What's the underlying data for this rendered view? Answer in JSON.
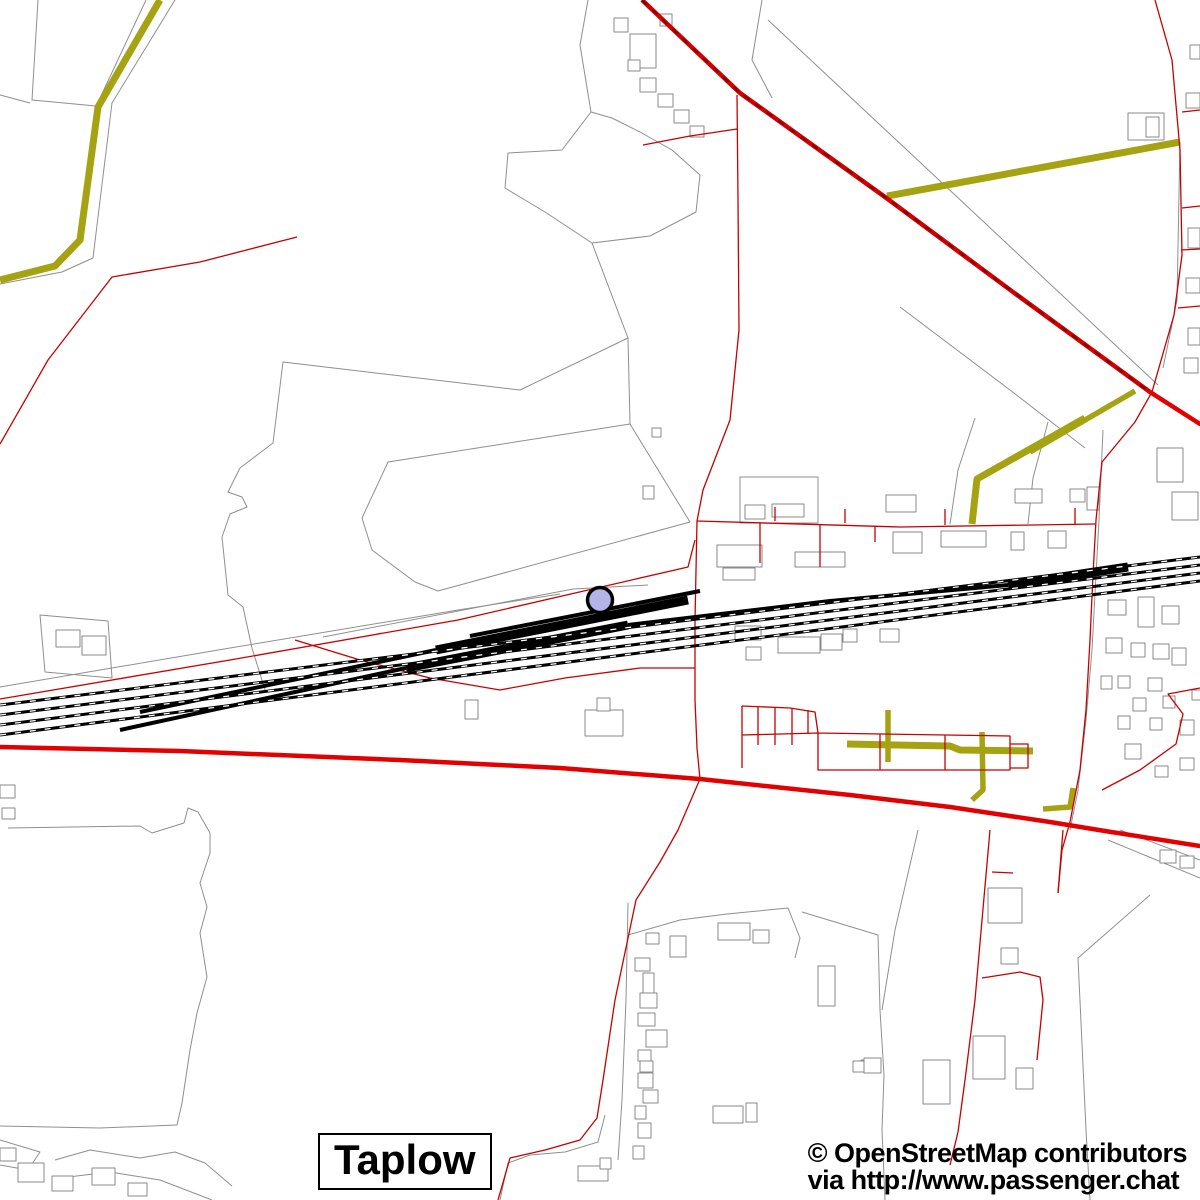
{
  "map": {
    "place_label": "Taplow",
    "attribution_line1": "© OpenStreetMap contributors",
    "attribution_line2": "via http://www.passenger.chat",
    "colors": {
      "background": "#ffffff",
      "railway": "#000000",
      "road_minor": "#c80000",
      "road_major": "#e30000",
      "road_trunk_pattern": "#8c0000",
      "track_path": "#a6a313",
      "boundary": "#8f8f8f",
      "station_marker_fill": "#b4b4e8",
      "station_marker_stroke": "#000000"
    },
    "canvas": {
      "width": 1200,
      "height": 1200
    },
    "station_marker": {
      "cx": 600,
      "cy": 600,
      "r": 12.5,
      "stroke_width": 3.5
    },
    "layers": [
      {
        "name": "parcel-boundaries",
        "stroke": "#8f8f8f",
        "width": 1,
        "paths": [
          "M175,0 L112,103 L93,258 L62,272 L0,284",
          "M146,0 L100,98",
          "M38,0 L32,100 L96,106",
          "M0,95 L30,103",
          "M588,0 L580,45 L591,112 L562,150 L508,153 L505,188 L545,212 L592,243 L650,236 L696,212 L700,175 L672,150 L640,132 L612,118 L591,112",
          "M762,0 L752,60 L772,98",
          "M768,20 L1158,385",
          "M592,243 L628,338 L520,390 L283,362 L273,443 L240,468 L228,492 L242,497 L247,507 L230,514 L222,537 L228,595 L243,607 L252,648 L265,690",
          "M628,338 L630,424 L388,462 L362,518 L372,550 L415,582 L438,591 L690,522 L630,424",
          "M0,687 L230,648 L458,610 L560,594",
          "M323,637 L573,589 L648,585",
          "M40,615 L108,621 L112,678 L45,672 Z",
          "M8,828 L140,826 L152,833 L184,823 L188,808 L198,812 L210,833 L210,853 L200,883 L207,907 L200,933 L207,977 L197,1013 L190,1050 L182,1103 L177,1125 L100,1128 L0,1126",
          "M0,1140 L40,1152 L28,1170 L0,1165",
          "M55,1160 L90,1150 L140,1158 L175,1152 L205,1163 L232,1186",
          "M60,1178 L110,1172 L160,1180 L212,1200",
          "M628,903 L626,1000 L622,1100 L618,1160",
          "M628,935 L680,920 L727,914 L788,908 L800,938 L795,958",
          "M802,912 L878,935 L880,1010 L884,1075 L882,1130 L885,1200",
          "M918,830 L895,930 L882,1010",
          "M1150,895 L1078,958 L1086,1130 L1090,1200",
          "M1103,430 L1099,520 L1096,575 L1092,650 L1086,720 L1078,790 L1070,830",
          "M1180,142 L1177,300 L1163,368",
          "M900,307 L1010,390 L1085,448",
          "M1048,422 L1033,478 L1028,524",
          "M975,418 L958,470 L950,524",
          "M740,477 L818,477 L818,523 L740,523 Z",
          "M605,1115 L598,1142 L565,1152 L530,1155 L508,1163 L500,1200",
          "M1108,840 L1200,878",
          "M1120,830 L1200,860"
        ]
      },
      {
        "name": "buildings",
        "stroke": "#8a8a8a",
        "width": 1,
        "fill": "#ffffff",
        "paths": [
          "M614,18h14v14h-14z",
          "M630,34h26v34h-26z",
          "M660,14h12v12h-12z",
          "M628,60h12v11h-12z",
          "M640,78h16v14h-16z",
          "M658,94h15v13h-15z",
          "M674,110h15v13h-15z",
          "M690,126h14v11h-14z",
          "M652,428h9v9h-9z",
          "M643,486h11v13h-11z",
          "M745,505h20v14h-20z",
          "M772,504h32v13h-32z",
          "M886,495h30v17h-30z",
          "M1015,489h27v14h-27z",
          "M1070,489h15v13h-15z",
          "M1087,487h12v23h-12z",
          "M717,545h45v22h-45z",
          "M723,568h32v12h-32z",
          "M795,552h50v15h-50z",
          "M893,532h29v21h-29z",
          "M941,531h45v16h-45z",
          "M1011,532h13v18h-13z",
          "M1048,531h18v17h-18z",
          "M735,626h26v14h-26z",
          "M778,637h42v16h-42z",
          "M821,634h21v16h-21z",
          "M843,629h14v13h-14z",
          "M880,629h19v13h-19z",
          "M746,647h15v13h-15z",
          "M465,700h13v19h-13z",
          "M585,710h38v26h-38z",
          "M597,698h13v13h-13z",
          "M1128,113h36v27h-36z",
          "M1146,117h13v20h-13z",
          "M1186,93h14v15h-14z",
          "M1190,45h10v14h-10z",
          "M1188,228h12v20h-12z",
          "M1186,278h14v15h-14z",
          "M1188,328h12v17h-12z",
          "M1184,358h14v15h-14z",
          "M1157,448h26v34h-26z",
          "M1172,492h26v28h-26z",
          "M1108,600h18v15h-18z",
          "M1138,597h16v30h-16z",
          "M1162,606h17v18h-17z",
          "M1106,638h16v15h-16z",
          "M1131,643h14v14h-14z",
          "M1153,644h16v15h-16z",
          "M1172,648h14v17h-14z",
          "M1101,676h11v13h-11z",
          "M1118,676h12v12h-12z",
          "M1148,678h14v13h-14z",
          "M1133,698h13v13h-13z",
          "M1163,696h12v12h-12z",
          "M1118,716h12v13h-12z",
          "M1150,718h12v12h-12z",
          "M1180,720h14v15h-14z",
          "M1192,690h10v10h-10z",
          "M1160,850h16v13h-16z",
          "M1180,856h14v12h-14z",
          "M1125,744h16v15h-16z",
          "M1155,766h13v11h-13z",
          "M1180,758h14v12h-14z",
          "M988,888h34v35h-34z",
          "M1001,948h17v16h-17z",
          "M973,1036h32v43h-32z",
          "M1016,1068h17v21h-17z",
          "M923,1060h27v44h-27z",
          "M861,1060h11v12h-11z",
          "M646,933h13v11h-13z",
          "M635,958h15v13h-15z",
          "M643,973h11v21h-11z",
          "M640,993h17v15h-17z",
          "M638,1013h17v13h-17z",
          "M646,1030h21v17h-21z",
          "M638,1050h13v11h-13z",
          "M640,1061h13v11h-13z",
          "M638,1073h15v15h-15z",
          "M643,1090h15v13h-15z",
          "M635,1106h11v13h-11z",
          "M638,1123h13v15h-13z",
          "M633,1146h11v13h-11z",
          "M670,936h16v21h-16z",
          "M718,923h32v17h-32z",
          "M753,930h16v13h-16z",
          "M818,966h17v40h-17z",
          "M853,1061h13v11h-13z",
          "M864,1058h17v15h-17z",
          "M713,1106h30v17h-30z",
          "M746,1103h11v19h-11z",
          "M578,1166h30v15h-30z",
          "M600,1158h11v11h-11z",
          "M18,1163h26v19h-26z",
          "M52,1176h21v15h-21z",
          "M92,1168h23v17h-23z",
          "M128,1183h19v13h-19z",
          "M0,1148h16v13h-16z",
          "M0,785h15v13h-15z",
          "M2,808h13v11h-13z",
          "M56,630h24v17h-24z",
          "M82,636h24v19h-24z"
        ]
      },
      {
        "name": "tracks-olive",
        "stroke": "#a6a313",
        "width": 7,
        "paths": [
          "M160,0 L98,107 L80,240 L55,266 L0,280",
          "M887,196 L1180,142",
          "M972,524 L977,479 L1085,418",
          "M847,744 L950,746 L960,750 L1033,751"
        ]
      },
      {
        "name": "tracks-olive-minor",
        "stroke": "#a6a313",
        "width": 5.5,
        "paths": [
          "M1030,452 L1135,391",
          "M888,710 L888,762",
          "M982,732 L983,790 L972,800",
          "M1043,809 L1070,807 L1073,788"
        ]
      },
      {
        "name": "roads-minor-red",
        "stroke": "#c80000",
        "width": 1.3,
        "paths": [
          "M737,95 L738,200 L739,330 L730,420 L703,490 L697,521",
          "M697,521 L695,620 L695,700 L697,748 L700,779",
          "M700,779 L678,830 L660,862 L636,900 L615,1000 L603,1080 L597,1118 L580,1140 L545,1150 L510,1158 L498,1200",
          "M643,145 L690,136 L737,129",
          "M297,237 L200,262 L112,277 L48,360 L0,444",
          "M0,699 L230,660 L458,620 L688,567 L695,540",
          "M697,521 L900,527 L1095,524",
          "M775,521 L775,507 M845,523 L845,509 M945,525 L945,509 M1075,524 L1075,508 M760,523 L760,563 M820,525 L820,567 M875,526 L875,542",
          "M1155,0 L1172,60 L1180,150 L1182,255 L1174,315 L1152,392",
          "M1182,112 L1200,110 M1182,208 L1200,206 M1181,250 L1200,249 M1178,308 L1200,306",
          "M1152,392 L1135,422 L1102,462 L1096,520 L1093,575 L1090,640 L1086,710 L1080,770 L1070,822 L1062,850 L1058,893",
          "M1200,688 L1168,694 L1183,714 L1176,744 L1140,770 L1102,790",
          "M990,830 L982,920 L975,1000 L965,1080 L958,1132 L950,1165",
          "M992,872 L1013,873",
          "M1063,830 L1058,893",
          "M982,978 L1020,972 L1040,977 L1043,1000 L1037,1060",
          "M742,706 L790,708 L815,712 L818,733",
          "M742,706 L742,768 M758,707 L758,745 M775,707 L775,745 M792,708 L792,745 M808,710 L808,734",
          "M742,735 L818,733 L818,770 L1010,770 L1010,736 L818,733",
          "M880,734 L880,770 M945,735 L945,770",
          "M1010,744 L1028,744 L1028,768 L1010,768",
          "M295,640 L360,660 L430,678 L500,690 L565,678 L640,668 L695,668"
        ]
      },
      {
        "name": "road-trunk-base",
        "stroke": "#d40000",
        "width": 4.5,
        "paths": [
          "M642,0 L740,93 L885,197 L1013,292 L1150,392"
        ]
      },
      {
        "name": "road-trunk-dashes",
        "stroke": "#8c0000",
        "width": 2.5,
        "dash": "7 7",
        "paths": [
          "M642,0 L740,93 L885,197 L1013,292 L1150,392"
        ]
      },
      {
        "name": "road-major-red",
        "stroke": "#e30000",
        "width": 4.5,
        "cap": "round",
        "paths": [
          "M0,747 L180,751 L400,760 L560,768 L700,779 L850,795 L950,807 L1050,822 L1105,831 L1200,846",
          "M1150,392 L1200,424"
        ]
      },
      {
        "name": "railway-mainlines",
        "stroke": "#000000",
        "width": 3,
        "paths": [
          "M0,705 L1200,557",
          "M0,715 L1200,565",
          "M0,725 L1200,573",
          "M0,735 L1200,581"
        ]
      },
      {
        "name": "railway-sidings-med",
        "stroke": "#000000",
        "width": 4,
        "paths": [
          "M470,636 L700,591",
          "M140,712 L436,650",
          "M120,730 L406,668",
          "M628,625 L830,601 L1008,585"
        ]
      },
      {
        "name": "railway-platforms-heavy",
        "stroke": "#000000",
        "width": 9,
        "paths": [
          "M436,650 L688,600",
          "M406,668 L628,625",
          "M1008,585 L1128,567"
        ]
      },
      {
        "name": "railway-dashes",
        "stroke": "#ffffff",
        "width": 1.3,
        "dash": "6 9",
        "paths": [
          "M0,705 L1200,557",
          "M0,715 L1200,565",
          "M0,725 L1200,573",
          "M0,735 L1200,581"
        ]
      }
    ]
  }
}
